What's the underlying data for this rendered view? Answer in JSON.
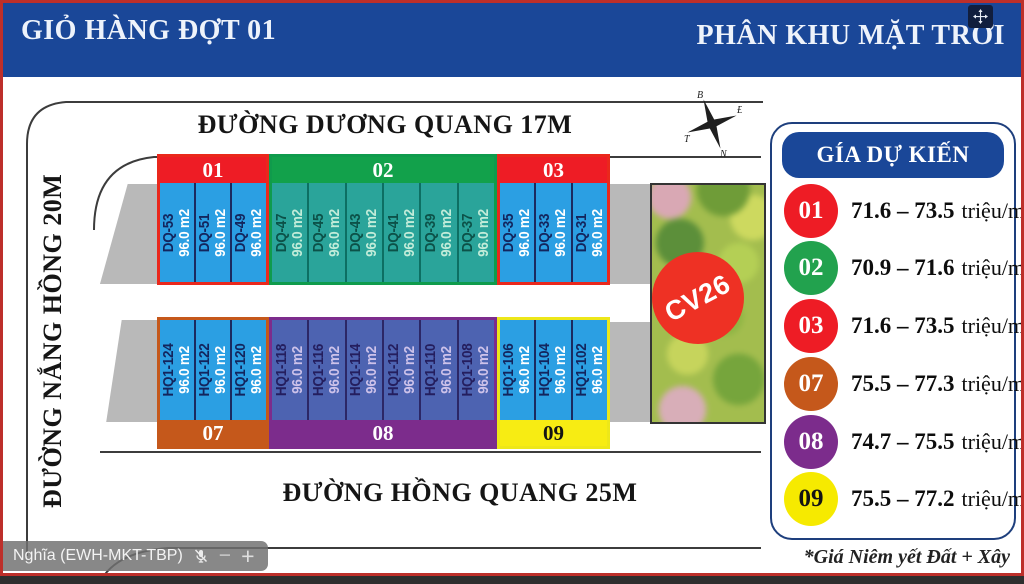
{
  "banner": {
    "left_title": "GIỎ HÀNG ĐỢT 01",
    "right_title": "PHÂN KHU MẶT TRỜI"
  },
  "map": {
    "street_top": "ĐƯỜNG DƯƠNG QUANG 17M",
    "street_left": "ĐƯỜNG NẮNG HỒNG 20M",
    "street_bottom": "ĐƯỜNG HỒNG QUANG 25M",
    "compass": {
      "north": "B",
      "east": "Đ",
      "south": "N",
      "west": "T"
    },
    "park_label": "CV26",
    "blocks": [
      {
        "id": "01",
        "color": "#ee1c25",
        "plots": [
          {
            "code": "DQ-53",
            "area": "96.0 m2"
          },
          {
            "code": "DQ-51",
            "area": "96.0 m2"
          },
          {
            "code": "DQ-49",
            "area": "96.0 m2"
          }
        ]
      },
      {
        "id": "02",
        "color": "#12a14b",
        "plots": [
          {
            "code": "DQ-47",
            "area": "96.0 m2"
          },
          {
            "code": "DQ-45",
            "area": "96.0 m2"
          },
          {
            "code": "DQ-43",
            "area": "96.0 m2"
          },
          {
            "code": "DQ-41",
            "area": "96.0 m2"
          },
          {
            "code": "DQ-39",
            "area": "96.0 m2"
          },
          {
            "code": "DQ-37",
            "area": "96.0 m2"
          }
        ]
      },
      {
        "id": "03",
        "color": "#ee1c25",
        "plots": [
          {
            "code": "DQ-35",
            "area": "96.0 m2"
          },
          {
            "code": "DQ-33",
            "area": "96.0 m2"
          },
          {
            "code": "DQ-31",
            "area": "96.0 m2"
          }
        ]
      },
      {
        "id": "07",
        "color": "#c5581b",
        "plots": [
          {
            "code": "HQ1-124",
            "area": "96.0 m2"
          },
          {
            "code": "HQ1-122",
            "area": "96.0 m2"
          },
          {
            "code": "HQ1-120",
            "area": "96.0 m2"
          }
        ]
      },
      {
        "id": "08",
        "color": "#7c2c8c",
        "plots": [
          {
            "code": "HQ1-118",
            "area": "96.0 m2"
          },
          {
            "code": "HQ1-116",
            "area": "96.0 m2"
          },
          {
            "code": "HQ1-114",
            "area": "96.0 m2"
          },
          {
            "code": "HQ1-112",
            "area": "96.0 m2"
          },
          {
            "code": "HQ1-110",
            "area": "96.0 m2"
          },
          {
            "code": "HQ1-108",
            "area": "96.0 m2"
          }
        ]
      },
      {
        "id": "09",
        "color": "#f7ec13",
        "plots": [
          {
            "code": "HQ1-106",
            "area": "96.0 m2"
          },
          {
            "code": "HQ1-104",
            "area": "96.0 m2"
          },
          {
            "code": "HQ1-102",
            "area": "96.0 m2"
          }
        ]
      }
    ]
  },
  "legend": {
    "title": "GÍA DỰ KIẾN",
    "rows": [
      {
        "id": "01",
        "color": "#ee1c25",
        "price": "71.6 – 73.5",
        "unit": "triệu/m2"
      },
      {
        "id": "02",
        "color": "#22a24e",
        "price": "70.9 – 71.6",
        "unit": "triệu/m2"
      },
      {
        "id": "03",
        "color": "#ee1c25",
        "price": "71.6 – 73.5",
        "unit": "triệu/m2"
      },
      {
        "id": "07",
        "color": "#c5581b",
        "price": "75.5 – 77.3",
        "unit": "triệu/m2"
      },
      {
        "id": "08",
        "color": "#7c2c8c",
        "price": "74.7 – 75.5",
        "unit": "triệu/m2"
      },
      {
        "id": "09",
        "color": "#f6ea00",
        "price": "75.5 – 77.2",
        "unit": "triệu/m2"
      }
    ],
    "footnote": "*Giá Niêm yết Đất + Xây"
  },
  "overlay": {
    "name_tag": "Nghĩa (EWH-MKT-TBP)",
    "minus": "−",
    "plus": "+"
  }
}
